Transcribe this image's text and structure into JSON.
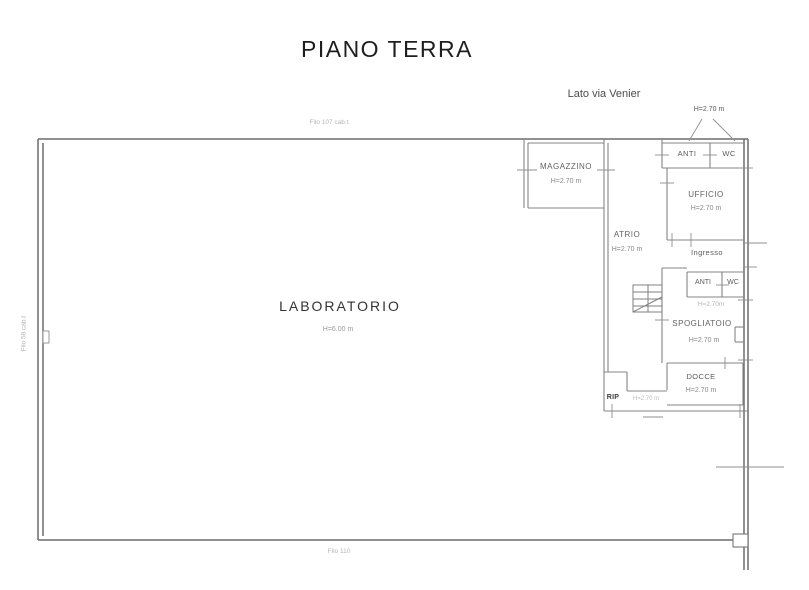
{
  "meta": {
    "doc_type": "architectural floor plan"
  },
  "colors": {
    "background": "#ffffff",
    "wall": "#7d7d7d",
    "wall_dark": "#6d6d6d",
    "label": "#3c3c3c",
    "muted": "#8a8a8a",
    "faint": "#b5b5b5",
    "title": "#1e1e1e"
  },
  "title": "PIANO TERRA",
  "annotations": {
    "street_side": "Lato via Venier",
    "roof_height_note": "H=2.70 m",
    "mid_block_height_note": "H=2.70m",
    "filo_top": "Filo 107 cab.t",
    "filo_left": "Filo 58 cab.t",
    "filo_bottom": "Filo 110"
  },
  "rooms": {
    "laboratorio": {
      "label": "LABORATORIO",
      "height": "H=6.00 m"
    },
    "magazzino": {
      "label": "MAGAZZINO",
      "height": "H=2.70 m"
    },
    "anti_top": {
      "label": "ANTI"
    },
    "wc_top": {
      "label": "WC"
    },
    "ufficio": {
      "label": "UFFICIO",
      "height": "H=2.70 m"
    },
    "atrio": {
      "label": "ATRIO",
      "height": "H=2.70 m"
    },
    "ingresso": {
      "label": "Ingresso"
    },
    "anti_mid": {
      "label": "ANTI"
    },
    "wc_mid": {
      "label": "WC"
    },
    "spogliatoio": {
      "label": "SPOGLIATOIO",
      "height": "H=2.70 m"
    },
    "docce": {
      "label": "DOCCE",
      "height": "H=2.70 m"
    },
    "rip": {
      "label": "RIP",
      "height": "H=2.70 m"
    }
  }
}
